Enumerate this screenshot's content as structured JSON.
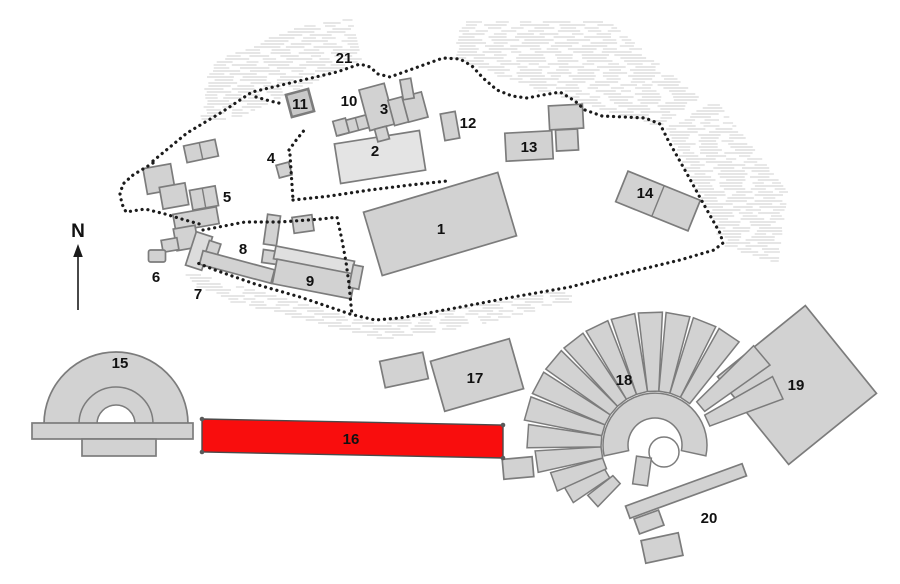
{
  "map_title": "site-plan",
  "compass": {
    "label": "N"
  },
  "labels": {
    "b1": "1",
    "b2": "2",
    "b3": "3",
    "b4": "4",
    "b5": "5",
    "b6": "6",
    "b7": "7",
    "b8": "8",
    "b9": "9",
    "b10": "10",
    "b11": "11",
    "b12": "12",
    "b13": "13",
    "b14": "14",
    "b15": "15",
    "b16": "16",
    "b17": "17",
    "b18": "18",
    "b19": "19",
    "b20": "20",
    "b21": "21"
  },
  "colors": {
    "background": "#ffffff",
    "building_fill": "#d2d2d2",
    "building_fill_light": "#e4e4e4",
    "building_outline": "#7c7c7c",
    "highlight_fill": "#f90d0d",
    "highlight_outline": "#4a4a4a",
    "boundary_dots": "#1b1b1b",
    "hatch_lines": "#d8d8d8",
    "label_text": "#111111",
    "handle_fill": "#5a5a5a"
  }
}
